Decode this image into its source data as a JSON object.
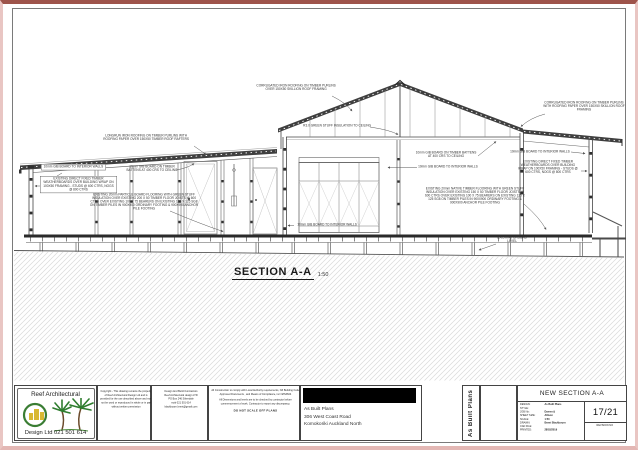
{
  "drawing": {
    "title": "SECTION A-A",
    "scale": "1:50",
    "annotations": {
      "left_roof": "LONGRUN IRON ROOFING ON TIMBER PURLINS WITH ROOFING PAPER OVER 150X50 TIMBER ROOF RAFTERS",
      "left_gib_walls": "10mm GIB BOARD TO INTERIOR WALLS",
      "left_weatherboards": "EXISTING DIRECT FIXED TIMBER WEATHERBOARDS OVER BUILDING WRAP ON 100X50 FRAMING - STUDS @ 600 CTRS, NOGS @ 800 CTRS",
      "left_ceiling_gib": "10mm GIB BOARD ON TIMBER BATTENS AT 400 CRS TO CEILING",
      "left_floor": "EXISTING 20mm PARTICLE BOARD FLOORING WITH GREEN STUFF INSULATION OVER EXISTING 200 X 50 TIMBER FLOOR JOISTS @ 600 CTRS OVER EXISTING 100 X 75 BEARERS ON EXISTING 125 X 125 SG8 ON TIMBER PILES IN 900X900 ORDINARY FOOTING & 900X900 ANCHOR PILE FOOTING",
      "mid_roof": "CORRUGATED IRON ROOFING ON TIMBER PURLINS OVER 150X50 SKILLION ROOF FRAMING",
      "ceiling_insulation": "R3.0 GREEN STUFF INSULATION TO CEILING",
      "mid_ceiling_gib": "10mm GIB BOARD ON TIMBER BATTENS AT 400 CRS TO CEILING",
      "mid_gib_walls": "10mm GIB BOARD TO INTERIOR WALLS",
      "mid_gib_walls_2": "10mm GIB BOARD TO INTERIOR WALLS",
      "right_gib_walls": "10mm GIB BOARD TO INTERIOR WALLS",
      "right_weatherboards": "EXISTING DIRECT FIXED TIMBER WEATHERBOARDS OVER BUILDING WRAP ON 100X50 FRAMING - STUDS @ 600 CTRS, NOGS @ 800 CTRS",
      "right_floor": "EXISTING 20mm NATIVE TIMBER FLOORING WITH GREEN STUFF INSULATION OVER EXISTING 150 X 50 TIMBER FLOOR JOISTS @ 600 CTRS OVER EXISTING 100 X 75 BEARERS ON EXISTING 125 X 125 SG8 ON TIMBER PILES IN 900X900 ORDINARY FOOTING & 900X900 ANCHOR PILE FOOTING",
      "right_roof": "CORRUGATED IRON ROOFING ON TIMBER PURLINS WITH ROOFING PAPER OVER 150X50 SKILLION ROOF FRAMING",
      "ground_level": "EXISTING GROUND LEVEL"
    }
  },
  "title_block": {
    "logo": {
      "name": "Reef Architectural",
      "phone": "Design Ltd 021 501 614"
    },
    "copyright": "Copyright - This drawing remains the property of Reef Architectural Design Ltd and is provided for the use described above and may not be used or reproduced in whole or in part without written permission",
    "contractor": [
      "Design And Build Contractors",
      "Reef Architectural design LTD",
      "PO Box 246 Silverdale",
      "mob 021 501 614",
      "blackbourn.brent@gmail.com"
    ],
    "compliance_1": "All Construction to comply with Local Authority requirements, NZ Building Code Approved Documents , and Means of Compliance, inc NZS3604",
    "compliance_2": "All Dimensions and levels are to be checked by contractor before commencement of work. Contractor to report any discrepancy.",
    "do_not_scale": "DO NOT SCALE OFF PLANS",
    "project": {
      "line1": "As Built Plans",
      "line2": "306 West Coast Road",
      "line3": "Komokoriki Auckland North"
    },
    "side_label": "As Built Plans",
    "drawing_title": "NEW SECTION A-A",
    "fields": [
      {
        "label": "DESIGN:",
        "value": "As Built Plans"
      },
      {
        "label": "STYLE:",
        "value": ""
      },
      {
        "label": "JOB No:",
        "value": "Darren &"
      },
      {
        "label": "SHEET SIZE:",
        "value": "Allison"
      },
      {
        "label": "SCALE:",
        "value": "1:50"
      },
      {
        "label": "DRAWN:",
        "value": "Brent Blackbourn"
      },
      {
        "label": "CAD FILE:",
        "value": ""
      },
      {
        "label": "PRINTED:",
        "value": "28/03/2019"
      }
    ],
    "sheet_number": "17/21",
    "revision_label": "REVISION NO"
  }
}
